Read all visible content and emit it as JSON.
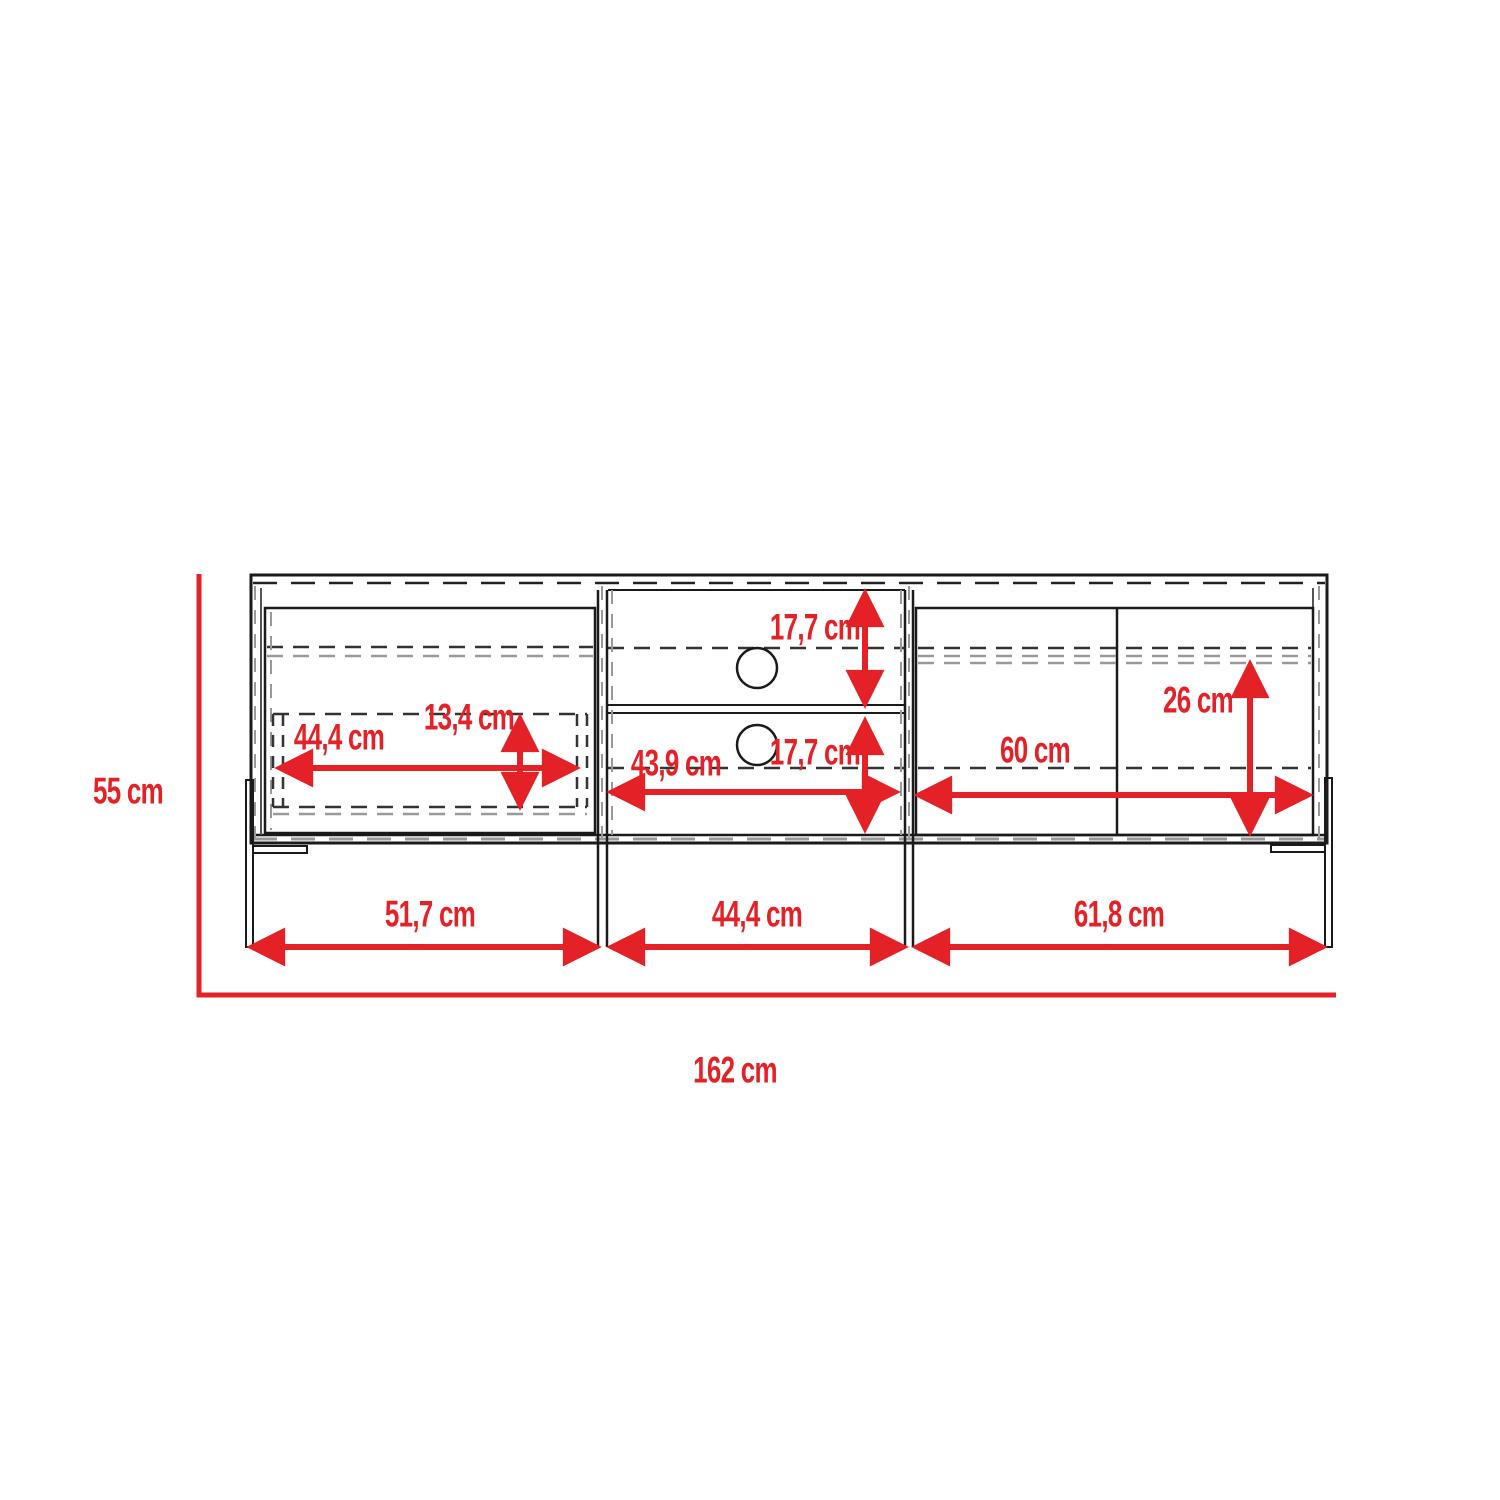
{
  "diagram": {
    "title": "TV stand front elevation with dimensions",
    "unit": "cm",
    "colors": {
      "dimension_red": "#e32126",
      "line_black": "#1a1a1a",
      "hidden_line_grey": "#999999"
    },
    "dims": {
      "total_height": "55 cm",
      "total_width": "162 cm",
      "left_section_width": "51,7 cm",
      "middle_section_width": "44,4 cm",
      "right_section_width": "61,8 cm",
      "left_drawer_width": "44,4 cm",
      "left_drawer_height": "13,4 cm",
      "middle_top_compartment_height": "17,7 cm",
      "middle_bottom_compartment_height": "17,7 cm",
      "middle_compartment_width": "43,9 cm",
      "right_cabinet_width": "60 cm",
      "right_cabinet_height": "26 cm"
    }
  }
}
